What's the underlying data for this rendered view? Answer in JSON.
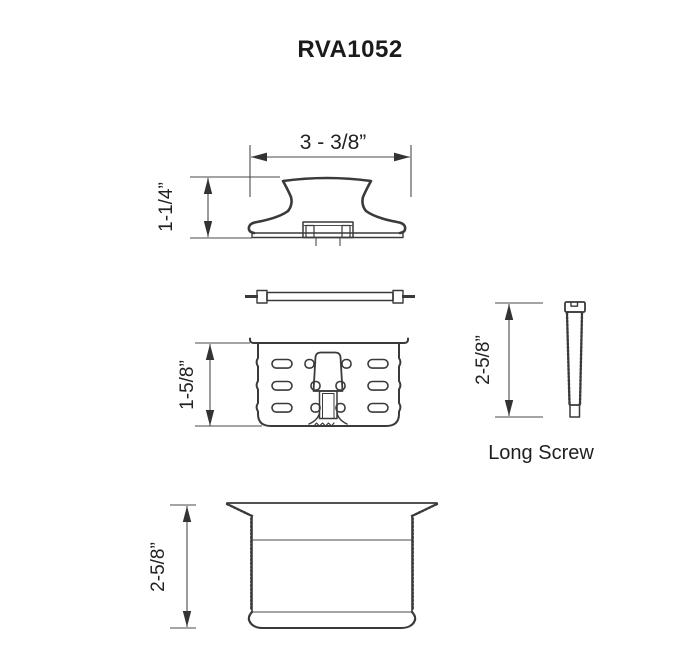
{
  "title": "RVA1052",
  "figures": {
    "stopper_top": {
      "name": "stopper cap cross-section",
      "width_dim": "3 - 3/8”",
      "height_dim": "1-1/4”"
    },
    "gasket": {
      "name": "flat crossbar / gasket edge view"
    },
    "basket": {
      "name": "slotted strainer basket cross-section",
      "height_dim": "1-5/8”"
    },
    "long_screw": {
      "name": "long screw side view",
      "length_dim": "2-5/8”",
      "label": "Long Screw"
    },
    "drain_body": {
      "name": "drain body cross-section",
      "height_dim": "2-5/8”"
    }
  },
  "colors": {
    "background": "#ffffff",
    "line": "#3a3a3a",
    "text": "#1c1c1c"
  }
}
